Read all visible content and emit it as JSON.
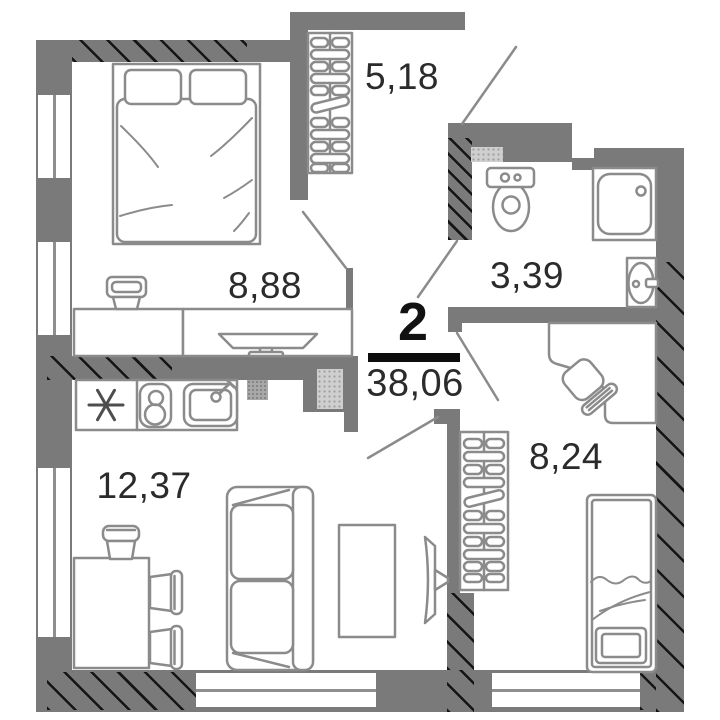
{
  "plan": {
    "type": "apartment-floor-plan",
    "summary": {
      "rooms_count": "2",
      "total_area": "38,06"
    },
    "rooms": [
      {
        "id": "hallway",
        "area": "5,18"
      },
      {
        "id": "bedroom",
        "area": "8,88"
      },
      {
        "id": "bathroom",
        "area": "3,39"
      },
      {
        "id": "kitchen-living-room",
        "area": "12,37"
      },
      {
        "id": "bedroom-2",
        "area": "8,24"
      }
    ],
    "colors": {
      "wall": "#7a7a7a",
      "furniture_stroke": "#8b8b8b",
      "hatch": "#1a1a1a",
      "label_text": "#2b2b2b",
      "divider_bar": "#0d0d0d",
      "background": "#ffffff"
    },
    "furniture_icons": [
      "double-bed-icon",
      "pillow-icon",
      "desk-icon",
      "chair-icon",
      "tv-unit-icon",
      "hallway-wardrobe-icon",
      "toilet-icon",
      "shower-icon",
      "washbasin-icon",
      "fridge-snowflake-icon",
      "stove-icon",
      "kitchen-sink-icon",
      "dining-table-icon",
      "dining-chair-icon",
      "sofa-icon",
      "coffee-table-icon",
      "wall-tv-icon",
      "corner-desk-icon",
      "office-chair-icon",
      "bedroom2-wardrobe-icon",
      "single-bed-icon"
    ]
  }
}
